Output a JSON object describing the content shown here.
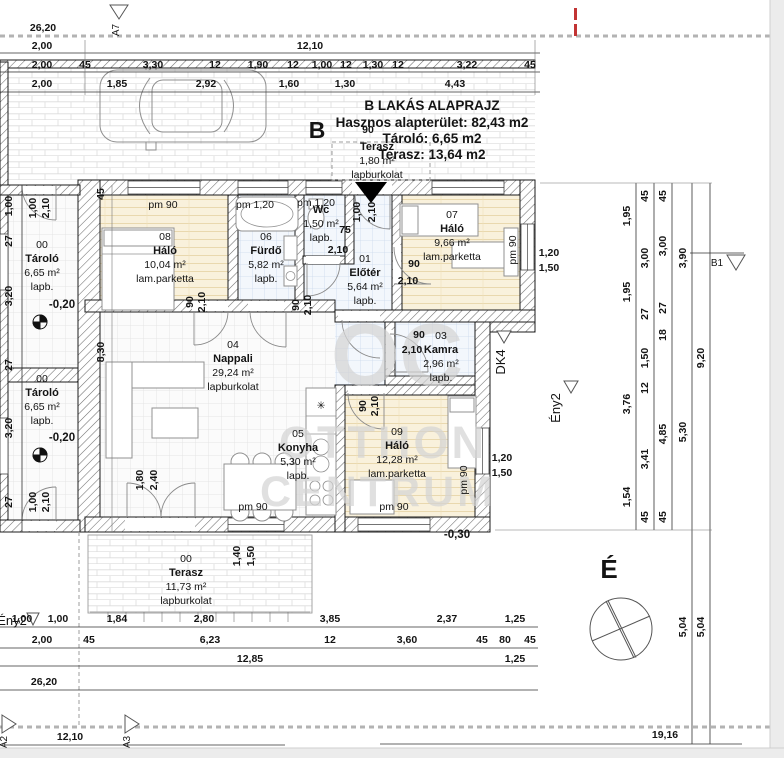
{
  "title": {
    "line1": "B LAKÁS ALAPRAJZ",
    "line2": "Hasznos alapterület: 82,43 m2",
    "line3": "Tároló: 6,65 m2",
    "line4": "Terasz:   13,64 m2"
  },
  "watermark": {
    "monogram": "OC",
    "word1": "OTTHON",
    "word2": "CENTRUM"
  },
  "rooms": [
    {
      "no": "08",
      "name": "Háló",
      "area": "10,04 m²",
      "floor": "lam.parketta",
      "x": 165,
      "y": 240
    },
    {
      "no": "06",
      "name": "Fürdő",
      "area": "5,82 m²",
      "floor": "lapb.",
      "x": 266,
      "y": 240
    },
    {
      "no": "",
      "name": "Wc",
      "area": "1,50 m²",
      "floor": "lapb.",
      "x": 321,
      "y": 213
    },
    {
      "no": "01",
      "name": "Előtér",
      "area": "5,64 m²",
      "floor": "lapb.",
      "x": 365,
      "y": 262
    },
    {
      "no": "07",
      "name": "Háló",
      "area": "9,66 m²",
      "floor": "lam.parketta",
      "x": 452,
      "y": 218
    },
    {
      "no": "03",
      "name": "Kamra",
      "area": "2,96 m²",
      "floor": "lapb.",
      "x": 441,
      "y": 339
    },
    {
      "no": "04",
      "name": "Nappali",
      "area": "29,24 m²",
      "floor": "lapburkolat",
      "x": 233,
      "y": 348
    },
    {
      "no": "05",
      "name": "Konyha",
      "area": "5,30 m²",
      "floor": "lapb.",
      "x": 298,
      "y": 437
    },
    {
      "no": "09",
      "name": "Háló",
      "area": "12,28 m²",
      "floor": "lam.parketta",
      "x": 397,
      "y": 435
    },
    {
      "no": "00",
      "name": "Tároló",
      "area": "6,65 m²",
      "floor": "lapb.",
      "x": 42,
      "y": 248
    },
    {
      "no": "00",
      "name": "Tároló",
      "area": "6,65 m²",
      "floor": "lapb.",
      "x": 42,
      "y": 382
    },
    {
      "no": "00",
      "name": "Terasz",
      "area": "11,73 m²",
      "floor": "lapburkolat",
      "x": 186,
      "y": 562
    },
    {
      "no": "",
      "name": "Terasz",
      "area": "1,80 m²",
      "floor": "lapburkolat",
      "x": 377,
      "y": 150
    }
  ],
  "labels": [
    {
      "t": "26,20",
      "x": 43,
      "y": 31
    },
    {
      "t": "2,00",
      "x": 42,
      "y": 49
    },
    {
      "t": "12,10",
      "x": 310,
      "y": 49
    },
    {
      "t": "2,00",
      "x": 42,
      "y": 68
    },
    {
      "t": "45",
      "x": 85,
      "y": 68
    },
    {
      "t": "3,30",
      "x": 153,
      "y": 68
    },
    {
      "t": "12",
      "x": 215,
      "y": 68
    },
    {
      "t": "1,90",
      "x": 258,
      "y": 68
    },
    {
      "t": "12",
      "x": 293,
      "y": 68
    },
    {
      "t": "1,00",
      "x": 322,
      "y": 68
    },
    {
      "t": "12",
      "x": 346,
      "y": 68
    },
    {
      "t": "1,30",
      "x": 373,
      "y": 68
    },
    {
      "t": "12",
      "x": 398,
      "y": 68
    },
    {
      "t": "3,22",
      "x": 467,
      "y": 68
    },
    {
      "t": "45",
      "x": 530,
      "y": 68
    },
    {
      "t": "2,00",
      "x": 42,
      "y": 87
    },
    {
      "t": "1,85",
      "x": 117,
      "y": 87
    },
    {
      "t": "2,92",
      "x": 206,
      "y": 87
    },
    {
      "t": "1,60",
      "x": 289,
      "y": 87
    },
    {
      "t": "1,30",
      "x": 345,
      "y": 87
    },
    {
      "t": "4,43",
      "x": 455,
      "y": 87
    },
    {
      "t": "A7",
      "x": 119,
      "y": 30,
      "r": -90,
      "c": "marker"
    },
    {
      "t": "B",
      "x": 317,
      "y": 138,
      "c": "bigb"
    },
    {
      "t": "90",
      "x": 368,
      "y": 133
    },
    {
      "t": "1,00",
      "x": 360,
      "y": 212,
      "r": -90
    },
    {
      "t": "2,10",
      "x": 375,
      "y": 212,
      "r": -90
    },
    {
      "t": "pm 90",
      "x": 163,
      "y": 208,
      "c": "room"
    },
    {
      "t": "pm 1,20",
      "x": 255,
      "y": 208,
      "c": "room"
    },
    {
      "t": "pm 1,20",
      "x": 316,
      "y": 206,
      "c": "room"
    },
    {
      "t": "90",
      "x": 193,
      "y": 302,
      "r": -90
    },
    {
      "t": "2,10",
      "x": 205,
      "y": 302,
      "r": -90
    },
    {
      "t": "90",
      "x": 299,
      "y": 305,
      "r": -90
    },
    {
      "t": "2,10",
      "x": 311,
      "y": 305,
      "r": -90
    },
    {
      "t": "75",
      "x": 345,
      "y": 233
    },
    {
      "t": "2,10",
      "x": 338,
      "y": 253
    },
    {
      "t": "90",
      "x": 414,
      "y": 267
    },
    {
      "t": "2,10",
      "x": 408,
      "y": 284
    },
    {
      "t": "pm 90",
      "x": 516,
      "y": 250,
      "r": -90,
      "c": "room"
    },
    {
      "t": "1,20",
      "x": 549,
      "y": 256
    },
    {
      "t": "1,50",
      "x": 549,
      "y": 271
    },
    {
      "t": "90",
      "x": 419,
      "y": 338
    },
    {
      "t": "2,10",
      "x": 412,
      "y": 353
    },
    {
      "t": "90",
      "x": 366,
      "y": 406,
      "r": -90
    },
    {
      "t": "2,10",
      "x": 378,
      "y": 406,
      "r": -90
    },
    {
      "t": "pm 90",
      "x": 467,
      "y": 480,
      "r": -90,
      "c": "room"
    },
    {
      "t": "pm 90",
      "x": 394,
      "y": 510,
      "c": "room"
    },
    {
      "t": "1,20",
      "x": 502,
      "y": 461
    },
    {
      "t": "1,50",
      "x": 502,
      "y": 476
    },
    {
      "t": "pm 90",
      "x": 253,
      "y": 510,
      "c": "room"
    },
    {
      "t": "1,80",
      "x": 143,
      "y": 480,
      "r": -90
    },
    {
      "t": "2,40",
      "x": 157,
      "y": 480,
      "r": -90
    },
    {
      "t": "-0,20",
      "x": 62,
      "y": 308,
      "c": "levelb"
    },
    {
      "t": "-0,20",
      "x": 62,
      "y": 441,
      "c": "levelb"
    },
    {
      "t": "-0,30",
      "x": 457,
      "y": 538,
      "c": "levelb"
    },
    {
      "t": "1,00",
      "x": 36,
      "y": 208,
      "r": -90
    },
    {
      "t": "2,10",
      "x": 49,
      "y": 208,
      "r": -90
    },
    {
      "t": "1,00",
      "x": 36,
      "y": 502,
      "r": -90
    },
    {
      "t": "2,10",
      "x": 49,
      "y": 502,
      "r": -90
    },
    {
      "t": "1,00",
      "x": 12,
      "y": 206,
      "r": -90
    },
    {
      "t": "27",
      "x": 12,
      "y": 241,
      "r": -90
    },
    {
      "t": "3,20",
      "x": 12,
      "y": 296,
      "r": -90
    },
    {
      "t": "27",
      "x": 12,
      "y": 365,
      "r": -90
    },
    {
      "t": "3,20",
      "x": 12,
      "y": 428,
      "r": -90
    },
    {
      "t": "27",
      "x": 12,
      "y": 502,
      "r": -90
    },
    {
      "t": "45",
      "x": 104,
      "y": 194,
      "r": -90
    },
    {
      "t": "8,30",
      "x": 104,
      "y": 352,
      "r": -90
    },
    {
      "t": "1,40",
      "x": 240,
      "y": 556,
      "r": -90
    },
    {
      "t": "1,50",
      "x": 254,
      "y": 556,
      "r": -90
    },
    {
      "t": "1,95",
      "x": 630,
      "y": 216,
      "r": -90
    },
    {
      "t": "1,95",
      "x": 630,
      "y": 292,
      "r": -90
    },
    {
      "t": "3,76",
      "x": 630,
      "y": 404,
      "r": -90
    },
    {
      "t": "1,54",
      "x": 630,
      "y": 497,
      "r": -90
    },
    {
      "t": "45",
      "x": 648,
      "y": 196,
      "r": -90
    },
    {
      "t": "3,00",
      "x": 648,
      "y": 258,
      "r": -90
    },
    {
      "t": "27",
      "x": 648,
      "y": 314,
      "r": -90
    },
    {
      "t": "1,50",
      "x": 648,
      "y": 358,
      "r": -90
    },
    {
      "t": "12",
      "x": 648,
      "y": 388,
      "r": -90
    },
    {
      "t": "3,41",
      "x": 648,
      "y": 459,
      "r": -90
    },
    {
      "t": "45",
      "x": 648,
      "y": 517,
      "r": -90
    },
    {
      "t": "45",
      "x": 666,
      "y": 196,
      "r": -90
    },
    {
      "t": "3,00",
      "x": 666,
      "y": 246,
      "r": -90
    },
    {
      "t": "27",
      "x": 666,
      "y": 308,
      "r": -90
    },
    {
      "t": "18",
      "x": 666,
      "y": 335,
      "r": -90
    },
    {
      "t": "4,85",
      "x": 666,
      "y": 434,
      "r": -90
    },
    {
      "t": "45",
      "x": 666,
      "y": 517,
      "r": -90
    },
    {
      "t": "3,90",
      "x": 686,
      "y": 258,
      "r": -90
    },
    {
      "t": "5,30",
      "x": 686,
      "y": 432,
      "r": -90
    },
    {
      "t": "5,04",
      "x": 686,
      "y": 627,
      "r": -90
    },
    {
      "t": "9,20",
      "x": 704,
      "y": 358,
      "r": -90
    },
    {
      "t": "5,04",
      "x": 704,
      "y": 627,
      "r": -90
    },
    {
      "t": "B1",
      "x": 717,
      "y": 266,
      "c": "marker"
    },
    {
      "t": "DK4",
      "x": 505,
      "y": 362,
      "r": -90,
      "c": "gray"
    },
    {
      "t": "Ény2",
      "x": 560,
      "y": 408,
      "r": -90,
      "c": "gray"
    },
    {
      "t": "Ény2",
      "x": 12,
      "y": 625,
      "c": "gray"
    },
    {
      "t": "É",
      "x": 609,
      "y": 578,
      "c": "bigE"
    },
    {
      "t": "1,00",
      "x": 22,
      "y": 622
    },
    {
      "t": "1,00",
      "x": 58,
      "y": 622
    },
    {
      "t": "1,84",
      "x": 117,
      "y": 622
    },
    {
      "t": "2,80",
      "x": 204,
      "y": 622
    },
    {
      "t": "3,85",
      "x": 330,
      "y": 622
    },
    {
      "t": "2,37",
      "x": 447,
      "y": 622
    },
    {
      "t": "1,25",
      "x": 515,
      "y": 622
    },
    {
      "t": "2,00",
      "x": 42,
      "y": 643
    },
    {
      "t": "45",
      "x": 89,
      "y": 643
    },
    {
      "t": "6,23",
      "x": 210,
      "y": 643
    },
    {
      "t": "12",
      "x": 330,
      "y": 643
    },
    {
      "t": "3,60",
      "x": 407,
      "y": 643
    },
    {
      "t": "45",
      "x": 482,
      "y": 643
    },
    {
      "t": "80",
      "x": 505,
      "y": 643
    },
    {
      "t": "45",
      "x": 530,
      "y": 643
    },
    {
      "t": "12,85",
      "x": 250,
      "y": 662
    },
    {
      "t": "1,25",
      "x": 515,
      "y": 662
    },
    {
      "t": "26,20",
      "x": 44,
      "y": 685
    },
    {
      "t": "12,10",
      "x": 70,
      "y": 740
    },
    {
      "t": "19,16",
      "x": 665,
      "y": 738
    },
    {
      "t": "A2",
      "x": 7,
      "y": 742,
      "r": -90,
      "c": "marker"
    },
    {
      "t": "A3",
      "x": 130,
      "y": 742,
      "r": -90,
      "c": "marker"
    },
    {
      "t": "✳",
      "x": 321,
      "y": 409,
      "c": "room"
    }
  ]
}
